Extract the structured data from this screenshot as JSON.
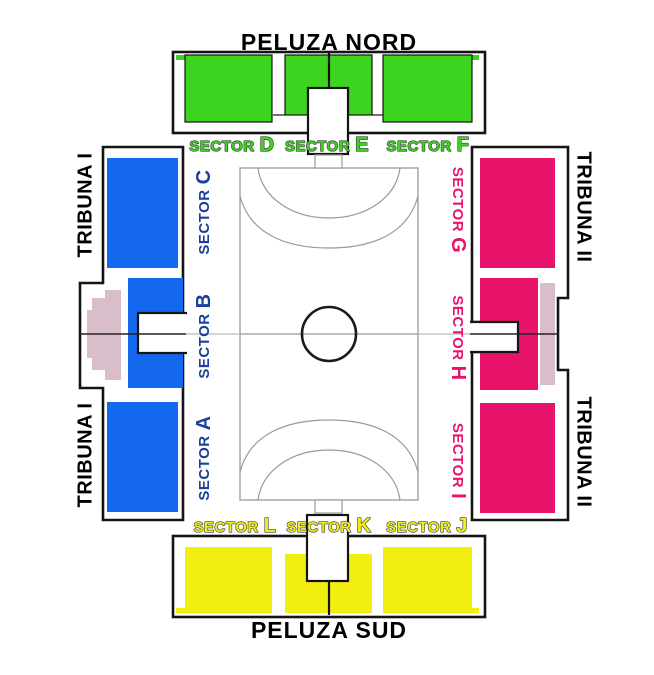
{
  "stands": {
    "north": {
      "name": "PELUZA NORD",
      "color": "#3CD41F",
      "sectors": [
        {
          "prefix": "SECTOR",
          "letter": "D"
        },
        {
          "prefix": "SECTOR",
          "letter": "E"
        },
        {
          "prefix": "SECTOR",
          "letter": "F"
        }
      ]
    },
    "south": {
      "name": "PELUZA SUD",
      "color": "#F2EE10",
      "sectors": [
        {
          "prefix": "SECTOR",
          "letter": "L"
        },
        {
          "prefix": "SECTOR",
          "letter": "K"
        },
        {
          "prefix": "SECTOR",
          "letter": "J"
        }
      ]
    },
    "west": {
      "name_top": "TRIBUNA I",
      "name_bottom": "TRIBUNA I",
      "color": "#1468EE",
      "label_color": "#1B3F9C",
      "sectors": [
        {
          "prefix": "SECTOR",
          "letter": "C"
        },
        {
          "prefix": "SECTOR",
          "letter": "B"
        },
        {
          "prefix": "SECTOR",
          "letter": "A"
        }
      ]
    },
    "east": {
      "name_top": "TRIBUNA II",
      "name_bottom": "TRIBUNA II",
      "color": "#E8146C",
      "label_color": "#E8146C",
      "sectors": [
        {
          "prefix": "SECTOR",
          "letter": "G"
        },
        {
          "prefix": "SECTOR",
          "letter": "H"
        },
        {
          "prefix": "SECTOR",
          "letter": "I"
        }
      ]
    }
  },
  "vip": {
    "color": "#D9BDCB"
  },
  "court": {
    "line_color": "#9A9A9A",
    "circle_color": "#1A1A1A"
  },
  "outline_color": "#141414"
}
